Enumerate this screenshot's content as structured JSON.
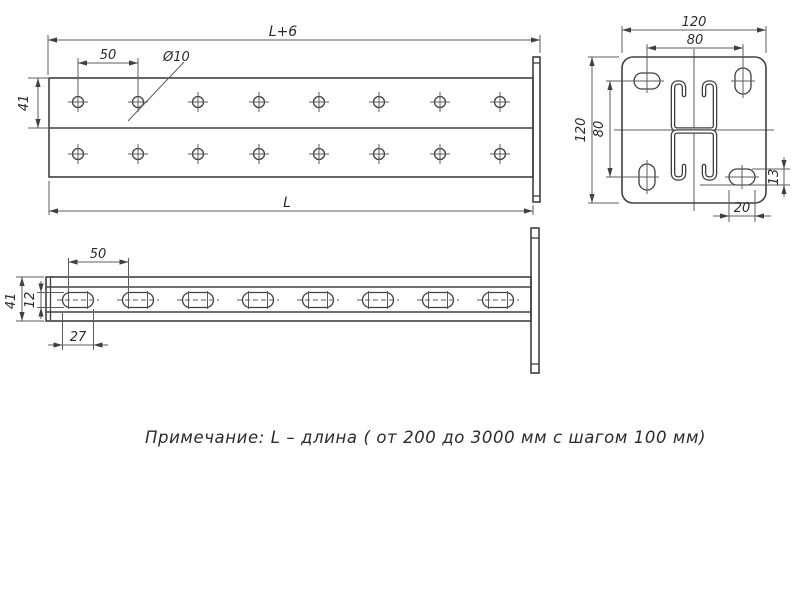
{
  "note": "Примечание: L – длина ( от 200 до 3000 мм с шагом 100 мм)",
  "views": {
    "side_top": {
      "dims": {
        "total_length": "L+6",
        "hole_pitch": "50",
        "hole_diameter": "Ø10",
        "height": "41",
        "length": "L"
      }
    },
    "end_plate": {
      "dims": {
        "plate_width": "120",
        "slot_pitch_h": "80",
        "plate_height": "120",
        "slot_pitch_v": "80",
        "slot_width": "13",
        "slot_length": "20"
      }
    },
    "side_bottom": {
      "dims": {
        "slot_pitch": "50",
        "height": "41",
        "slot_height": "12",
        "slot_length": "27"
      }
    }
  },
  "colors": {
    "object_line": "#404040",
    "thin_line": "#5c5c5c",
    "text": "#2b2b2b",
    "background": "#ffffff"
  }
}
